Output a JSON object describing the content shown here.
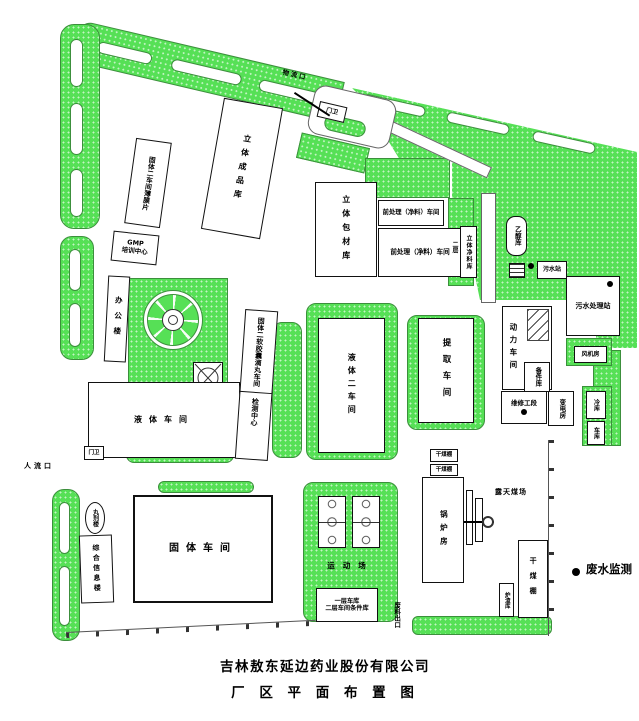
{
  "title": {
    "company": "吉林敖东延边药业股份有限公司",
    "drawing": "厂 区 平 面 布 置 图"
  },
  "legend": {
    "wastewater_monitoring": "废水监测"
  },
  "gates": {
    "logistics_gate": "物流口",
    "north_guard": "门卫",
    "people_gate": "人流口",
    "west_guard": "门卫",
    "waste_exit": "废料出口"
  },
  "areas": {
    "sports_field": "运动场",
    "open_coal_yard": "露天煤场"
  },
  "buildings": {
    "solid2_film_workshop": "固体二车间薄膜片",
    "finished_goods_warehouse": "立体成品库",
    "gmp_line1": "GMP",
    "gmp_line2": "培训中心",
    "office_building": "办公楼",
    "packaging_warehouse": "立体包材库",
    "pretreatment_workshop_1": "前处理（净料）车间",
    "pretreatment_workshop_2": "前处理（净料）车间",
    "second_floor": "二层",
    "clean_material_warehouse": "立体净料库",
    "ethanol_warehouse": "乙醇库",
    "sewage_station": "污水站",
    "sewage_treatment_plant": "污水处理站",
    "liquid_workshop": "液体车间",
    "softgel_dripping_pill_workshop": "固体二软胶囊滴丸车间",
    "testing_center": "检测中心",
    "liquid_workshop_2": "液体二车间",
    "extraction_workshop": "提取车间",
    "power_workshop": "动力车间",
    "fan_room": "风机房",
    "spare_parts_warehouse": "备件库",
    "maintenance_section": "维修工段",
    "transformer_room": "变电房",
    "cold_storage": "冷库",
    "garage": "车库",
    "pill_building": "丸剂楼",
    "info_building": "综合信息楼",
    "solid_workshop": "固体车间",
    "garage_level1": "一层车库",
    "garage_level2": "二层车间条件库",
    "dry_coal_shed_1": "干煤棚",
    "dry_coal_shed_2": "干煤棚",
    "dry_coal_shed_3": "干煤棚",
    "boiler_house": "锅炉房",
    "slag_warehouse": "炉渣库"
  }
}
